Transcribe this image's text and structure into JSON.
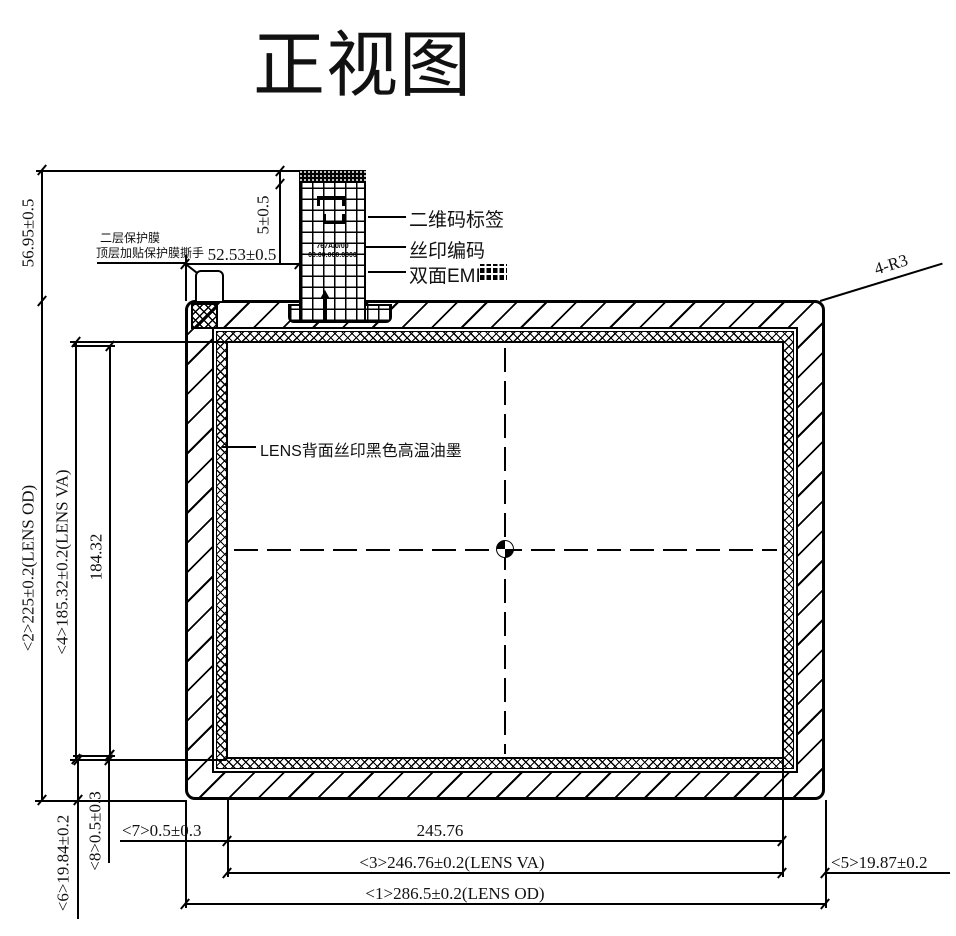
{
  "title": "正视图",
  "corner_note": "4-R3",
  "center_label": "LENS背面丝印黑色高温油墨",
  "tab": {
    "label_qr": "二维码标签",
    "label_silk": "丝印编码",
    "label_emi": "双面EMI",
    "code_line1": "767A/0/00",
    "code_line2": "00.00.000.0000"
  },
  "film_note": {
    "line1": "二层保护膜",
    "line2": "顶层加贴保护膜撕手"
  },
  "dims": {
    "d56": "56.95±0.5",
    "d52": "52.53±0.5",
    "d5top": "5±0.5",
    "d2": "<2>225±0.2(LENS OD)",
    "d4": "<4>185.32±0.2(LENS VA)",
    "d184": "184.32",
    "d6": "<6>19.84±0.2",
    "d8": "<8>0.5±0.3",
    "d7": "<7>0.5±0.3",
    "d245": "245.76",
    "d3": "<3>246.76±0.2(LENS VA)",
    "d1": "<1>286.5±0.2(LENS OD)",
    "d5right": "<5>19.87±0.2"
  },
  "colors": {
    "line": "#000000",
    "background": "#ffffff"
  }
}
